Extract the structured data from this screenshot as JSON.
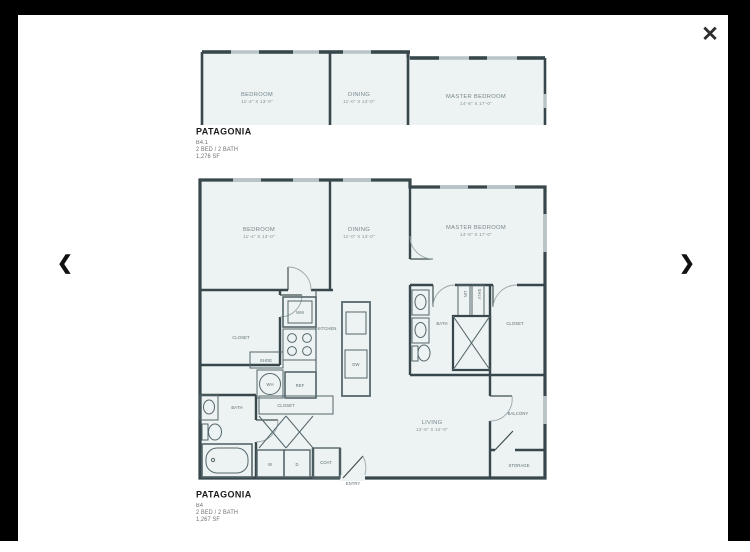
{
  "lightbox": {
    "close_icon": "✕",
    "prev_icon": "❮",
    "next_icon": "❯",
    "frame_color": "#000000",
    "wall_color": "#37474b",
    "window_color": "#b7c3c7",
    "room_fill": "#edf2f2"
  },
  "plans": [
    {
      "title": "PATAGONIA",
      "unit": "B4.1",
      "config": "2 BED / 2 BATH",
      "area": "1,276 SF",
      "rooms": {
        "bedroom": {
          "name": "BEDROOM",
          "dims": "11'-4\" X 13'-0\""
        },
        "dining": {
          "name": "DINING",
          "dims": "11'-0\" X 13'-0\""
        },
        "master": {
          "name": "MASTER BEDROOM",
          "dims": "14'-8\" X 17'-0\""
        }
      }
    },
    {
      "title": "PATAGONIA",
      "unit": "B4",
      "config": "2 BED / 2 BATH",
      "area": "1,267 SF",
      "rooms": {
        "bedroom": {
          "name": "BEDROOM",
          "dims": "11'-4\" X 13'-0\""
        },
        "dining": {
          "name": "DINING",
          "dims": "11'-0\" X 13'-0\""
        },
        "master": {
          "name": "MASTER BEDROOM",
          "dims": "14'-8\" X 17'-0\""
        },
        "living": {
          "name": "LIVING",
          "dims": "12'-6\" X 12'-0\""
        },
        "kitchen": "KITCHEN",
        "closet_left": "CLOSET",
        "shoe": "SHOE",
        "wm": "WM",
        "wh": "WH",
        "ref": "REF",
        "dw": "DW",
        "bath_left": "BATH",
        "closet_hall": "CLOSET",
        "washer": "W",
        "dryer": "D",
        "coat": "COAT",
        "entry": "ENTRY",
        "bath_master": "BATH",
        "lin": "LIN",
        "shlv": "SHLV",
        "closet_master": "CLOSET",
        "balcony": "BALCONY",
        "storage": "STORAGE"
      }
    }
  ]
}
